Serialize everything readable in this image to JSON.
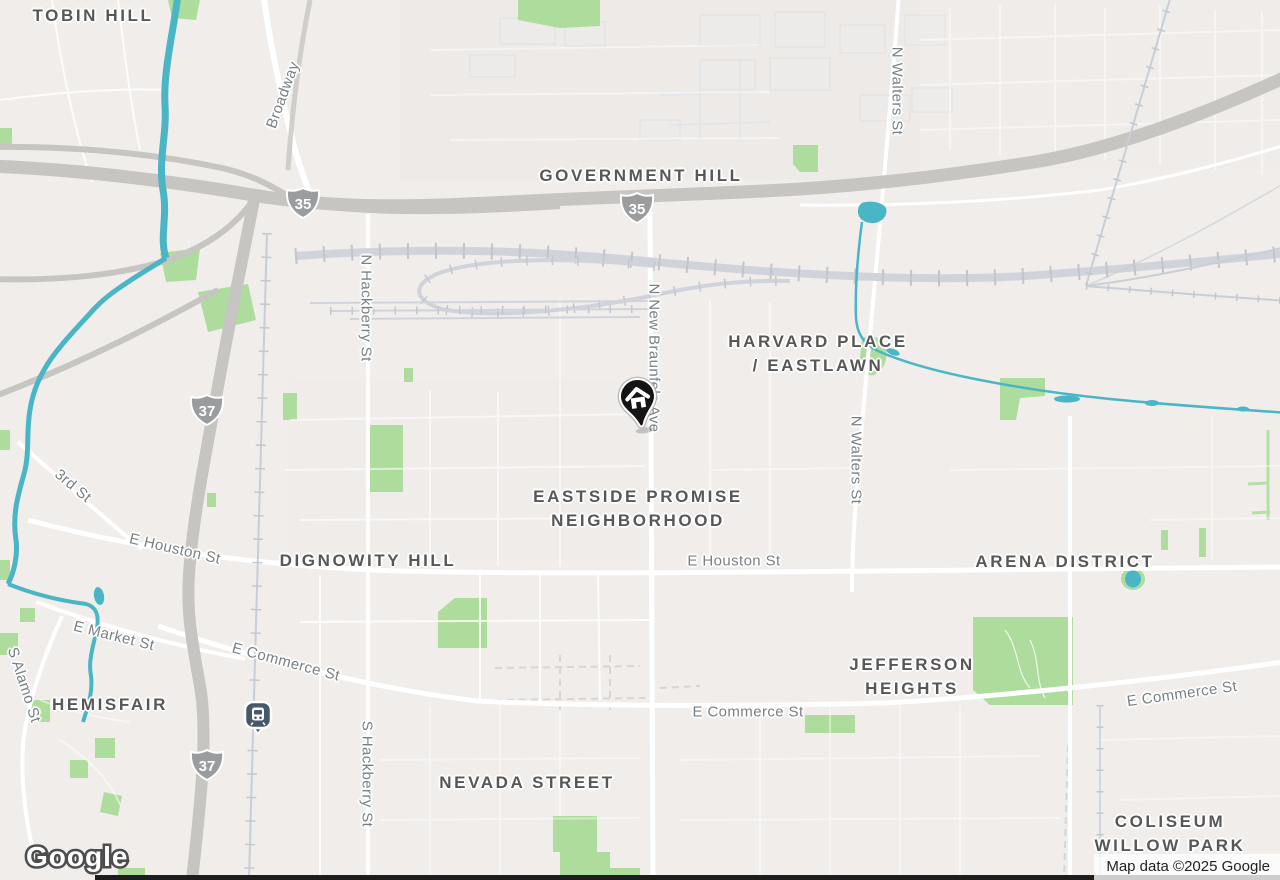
{
  "map": {
    "logo_text": "Google",
    "attribution": "Map data ©2025 Google",
    "marker": {
      "name": "home-pin",
      "color": "#111111"
    },
    "transit_station": {
      "name": "train-station",
      "color": "#46596c"
    },
    "colors": {
      "background": "#f0edeb",
      "water": "#49b5c5",
      "park": "#aedc9d",
      "freeway": "#c7c5c2",
      "road": "#ffffff",
      "rail": "#ced2d9",
      "neighborhood_text": "#575757",
      "street_text": "#7a7f83",
      "shield": "#9b9c9e"
    },
    "neighborhoods": [
      {
        "id": "tobin-hill",
        "lines": [
          "TOBIN HILL"
        ],
        "x": 93,
        "y": 16
      },
      {
        "id": "government-hill",
        "lines": [
          "GOVERNMENT HILL"
        ],
        "x": 641,
        "y": 176
      },
      {
        "id": "harvard-place-eastlawn",
        "lines": [
          "HARVARD PLACE",
          "/ EASTLAWN"
        ],
        "x": 818,
        "y": 354
      },
      {
        "id": "eastside-promise",
        "lines": [
          "EASTSIDE PROMISE",
          "NEIGHBORHOOD"
        ],
        "x": 638,
        "y": 509
      },
      {
        "id": "dignowity-hill",
        "lines": [
          "DIGNOWITY HILL"
        ],
        "x": 368,
        "y": 561
      },
      {
        "id": "arena-district",
        "lines": [
          "ARENA DISTRICT"
        ],
        "x": 1065,
        "y": 562
      },
      {
        "id": "jefferson-heights",
        "lines": [
          "JEFFERSON",
          "HEIGHTS"
        ],
        "x": 912,
        "y": 677
      },
      {
        "id": "hemisfair",
        "lines": [
          "HEMISFAIR"
        ],
        "x": 110,
        "y": 705
      },
      {
        "id": "nevada-street",
        "lines": [
          "NEVADA STREET"
        ],
        "x": 527,
        "y": 783
      },
      {
        "id": "coliseum-willow-park",
        "lines": [
          "COLISEUM",
          "WILLOW PARK"
        ],
        "x": 1170,
        "y": 834
      }
    ],
    "streets": [
      {
        "id": "broadway",
        "label": "Broadway",
        "x": 283,
        "y": 95,
        "rot": -70
      },
      {
        "id": "n-hackberry-st",
        "label": "N Hackberry St",
        "x": 366,
        "y": 308,
        "rot": 90
      },
      {
        "id": "s-hackberry-st",
        "label": "S Hackberry St",
        "x": 367,
        "y": 774,
        "rot": 90
      },
      {
        "id": "n-new-braunfels-ave",
        "label": "N New Braunfels Ave",
        "x": 654,
        "y": 358,
        "rot": 90
      },
      {
        "id": "n-walters-st-top",
        "label": "N Walters St",
        "x": 897,
        "y": 91,
        "rot": 90
      },
      {
        "id": "n-walters-st-mid",
        "label": "N Walters St",
        "x": 856,
        "y": 460,
        "rot": 90
      },
      {
        "id": "e-houston-st-left",
        "label": "E Houston St",
        "x": 175,
        "y": 549,
        "rot": 13
      },
      {
        "id": "e-houston-st-right",
        "label": "E Houston St",
        "x": 734,
        "y": 561,
        "rot": 0
      },
      {
        "id": "e-market-st",
        "label": "E Market St",
        "x": 114,
        "y": 636,
        "rot": 14
      },
      {
        "id": "e-commerce-st-left",
        "label": "E Commerce St",
        "x": 286,
        "y": 662,
        "rot": 15
      },
      {
        "id": "e-commerce-st-center",
        "label": "E Commerce St",
        "x": 748,
        "y": 712,
        "rot": 0
      },
      {
        "id": "e-commerce-st-right",
        "label": "E Commerce St",
        "x": 1182,
        "y": 694,
        "rot": -8
      },
      {
        "id": "third-st",
        "label": "3rd St",
        "x": 73,
        "y": 486,
        "rot": 40
      },
      {
        "id": "s-alamo-st",
        "label": "S Alamo St",
        "x": 24,
        "y": 685,
        "rot": 72
      }
    ],
    "shields": [
      {
        "label": "35",
        "x": 303,
        "y": 203
      },
      {
        "label": "35",
        "x": 637,
        "y": 208
      },
      {
        "label": "37",
        "x": 207,
        "y": 410
      },
      {
        "label": "37",
        "x": 207,
        "y": 765
      }
    ]
  }
}
